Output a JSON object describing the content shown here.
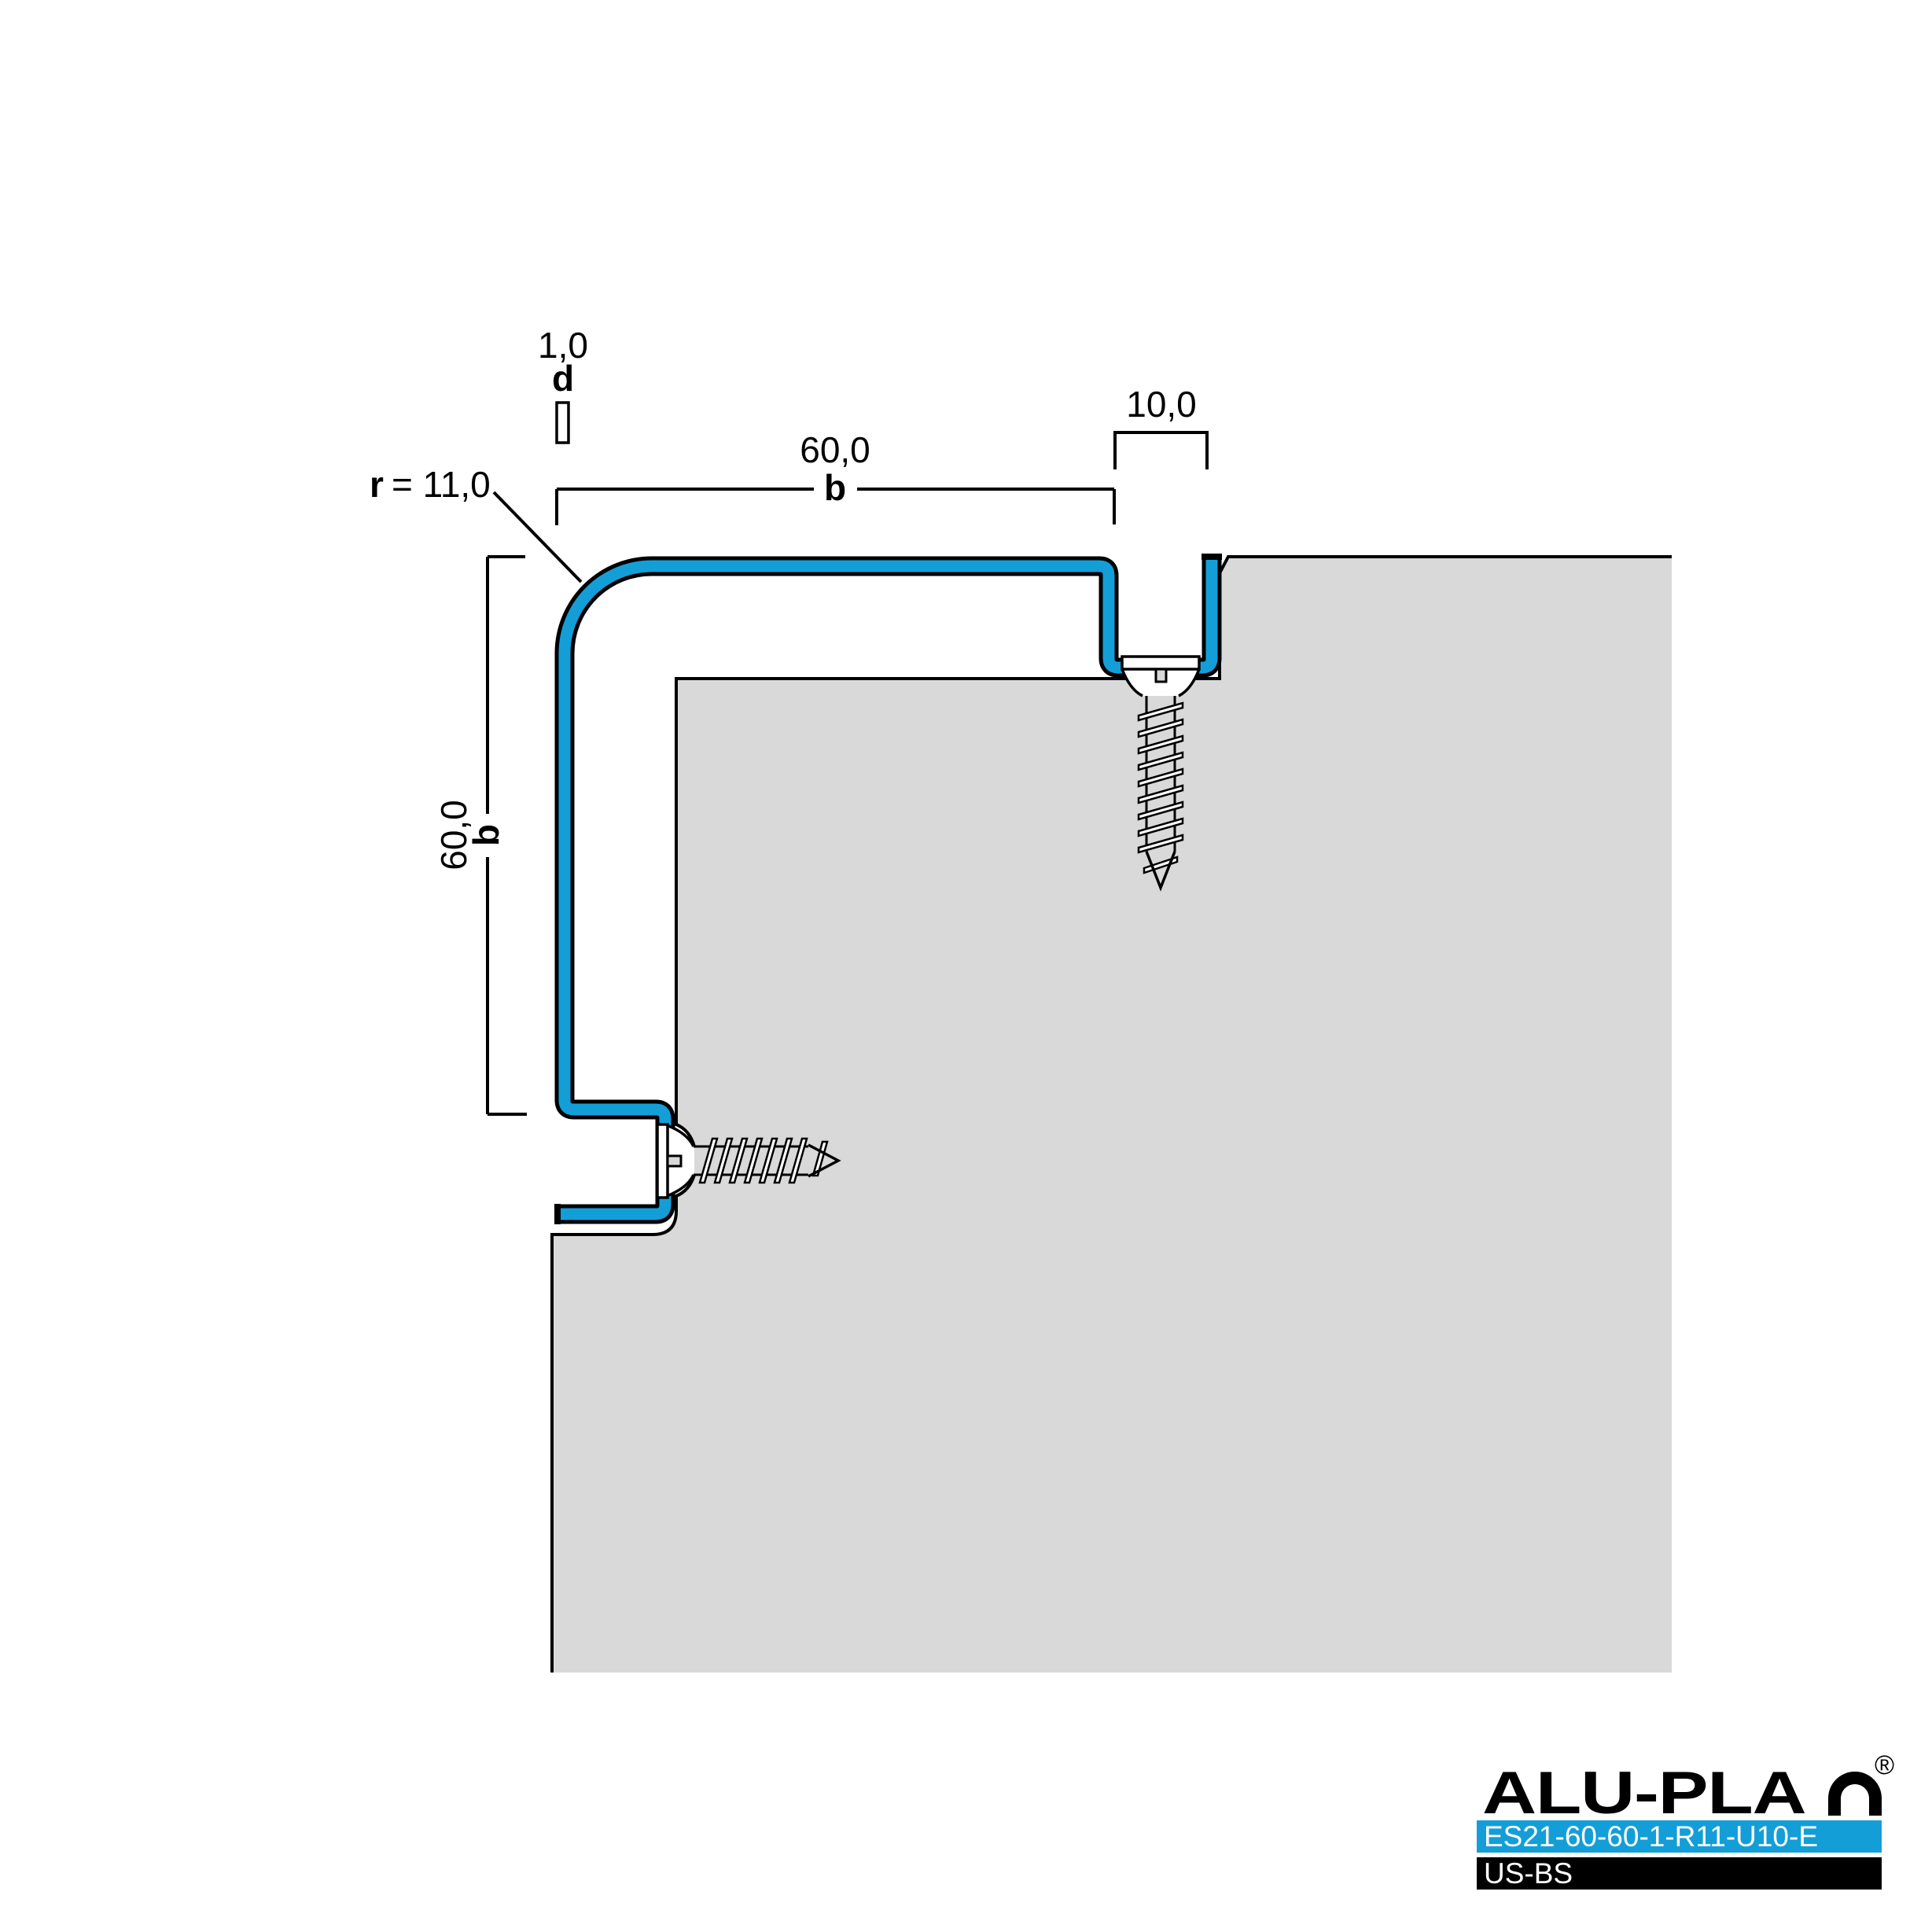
{
  "colors": {
    "profile_blue": "#149ED8",
    "substrate_gray": "#D9D9D9",
    "bar_blue": "#149ED8",
    "bar_black": "#000000",
    "line": "#000000"
  },
  "dimensions": {
    "thickness": {
      "value": "1,0",
      "symbol": "d"
    },
    "width": {
      "value": "60,0",
      "symbol": "b"
    },
    "height": {
      "value": "60,0",
      "symbol": "b"
    },
    "top_leg": {
      "value": "10,0"
    },
    "radius": {
      "symbol": "r",
      "value": "= 11,0"
    }
  },
  "logo": {
    "brand_prefix": "ALU-PLA",
    "brand_name": "ALU-PLAN",
    "registered": "®",
    "product_code": "ES21-60-60-1-R11-U10-E",
    "type_code": "US-BS"
  }
}
